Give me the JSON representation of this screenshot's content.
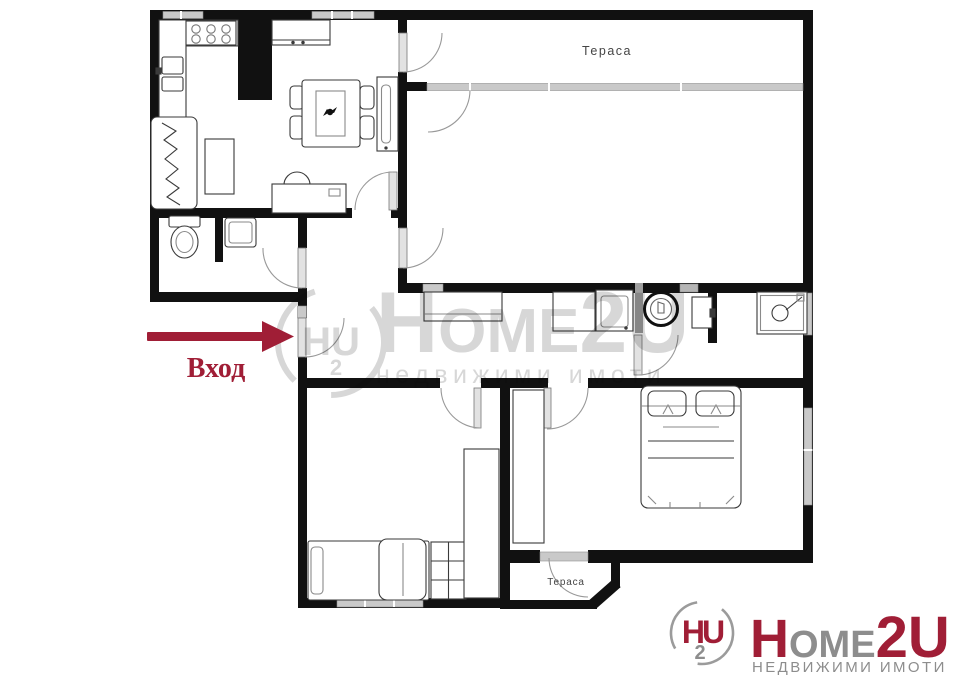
{
  "page": {
    "width": 960,
    "height": 679,
    "background": "#ffffff"
  },
  "colors": {
    "wall": "#111111",
    "accent_red": "#a01e36",
    "logo_gray": "#8d8d8d",
    "window_gray": "#c9c9c9",
    "door_gray": "#e2e2e2",
    "label_gray": "#454545",
    "watermark_gray": "#d7d7d7"
  },
  "plan": {
    "terrace_top_label": "Тераса",
    "terrace_bottom_label": "Тераса",
    "entrance_label": "Вход",
    "rooms": [
      "living-room-kitchen",
      "terrace-top",
      "big-room",
      "wc",
      "hallway",
      "bathroom",
      "bedroom-left",
      "bedroom-right",
      "terrace-bottom"
    ],
    "furniture_icons": [
      "kitchen-hob-icon",
      "kitchen-sink-icon",
      "fridge-column-icon",
      "sideboard-icon",
      "sofa-icon",
      "coffee-table-icon",
      "dining-table-icon",
      "chair-icon",
      "tv-icon",
      "desk-icon",
      "desk-chair-icon",
      "toilet-icon",
      "washbasin-icon",
      "console-table-icon",
      "appliance-icon",
      "laundry-sink-icon",
      "washing-machine-icon",
      "bath-cabinet-icon",
      "shower-icon",
      "single-bed-icon",
      "grid-cabinet-icon",
      "wardrobe-icon",
      "double-bed-icon"
    ]
  },
  "watermark": {
    "word_h": "H",
    "word_ome": "OME",
    "word_2u": "2U",
    "line2": "недвижими имоти",
    "emblem": "HU",
    "emblem_sub": "2"
  },
  "logo": {
    "emblem_hu": "HU",
    "emblem_2": "2",
    "word_h": "H",
    "word_ome": "OME",
    "word_2u": "2U",
    "subtext": "НЕДВИЖИМИ ИМОТИ"
  }
}
